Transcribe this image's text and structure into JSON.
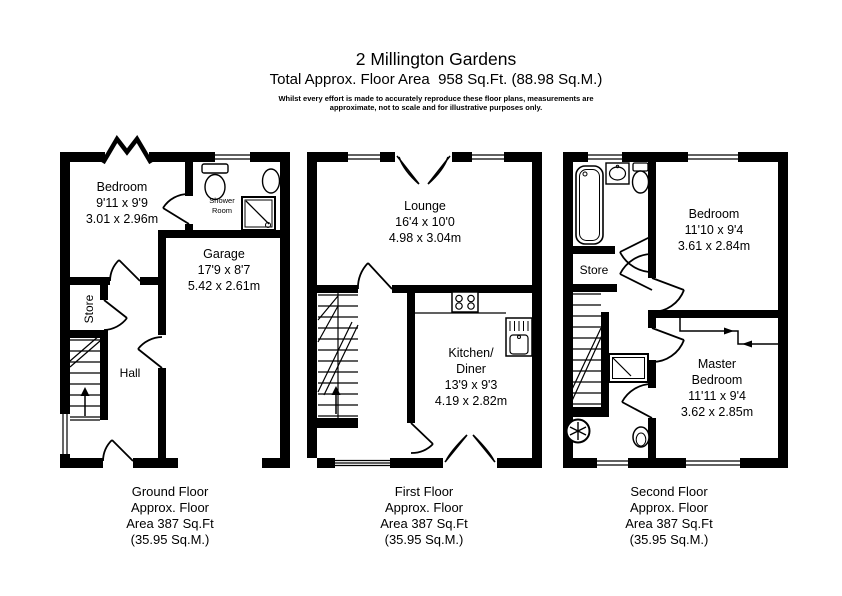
{
  "header": {
    "title": "2 Millington Gardens",
    "subtitle": "Total Approx. Floor Area  958 Sq.Ft. (88.98 Sq.M.)",
    "disclaimer_line1": "Whilst every effort is made to accurately reproduce these floor plans, measurements are",
    "disclaimer_line2": "approximate, not to scale and for illustrative purposes only."
  },
  "colors": {
    "wall": "#000000",
    "background": "#ffffff",
    "text": "#000000"
  },
  "floors": {
    "ground": {
      "caption": [
        "Ground Floor",
        "Approx. Floor",
        "Area 387 Sq.Ft",
        "(35.95 Sq.M.)"
      ],
      "rooms": {
        "bedroom": {
          "name": "Bedroom",
          "imperial": "9'11 x 9'9",
          "metric": "3.01 x 2.96m"
        },
        "shower_room": {
          "name_line1": "Shower",
          "name_line2": "Room"
        },
        "garage": {
          "name": "Garage",
          "imperial": "17'9 x 8'7",
          "metric": "5.42 x 2.61m"
        },
        "store": {
          "name": "Store"
        },
        "hall": {
          "name": "Hall"
        }
      }
    },
    "first": {
      "caption": [
        "First Floor",
        "Approx. Floor",
        "Area 387 Sq.Ft",
        "(35.95 Sq.M.)"
      ],
      "rooms": {
        "lounge": {
          "name": "Lounge",
          "imperial": "16'4 x 10'0",
          "metric": "4.98 x 3.04m"
        },
        "kitchen_diner": {
          "name_line1": "Kitchen/",
          "name_line2": "Diner",
          "imperial": "13'9 x 9'3",
          "metric": "4.19 x 2.82m"
        }
      }
    },
    "second": {
      "caption": [
        "Second Floor",
        "Approx. Floor",
        "Area 387 Sq.Ft",
        "(35.95 Sq.M.)"
      ],
      "rooms": {
        "bedroom": {
          "name": "Bedroom",
          "imperial": "11'10 x 9'4",
          "metric": "3.61 x 2.84m"
        },
        "master_bedroom": {
          "name_line1": "Master",
          "name_line2": "Bedroom",
          "imperial": "11'11 x 9'4",
          "metric": "3.62 x 2.85m"
        },
        "store": {
          "name": "Store"
        }
      }
    }
  }
}
